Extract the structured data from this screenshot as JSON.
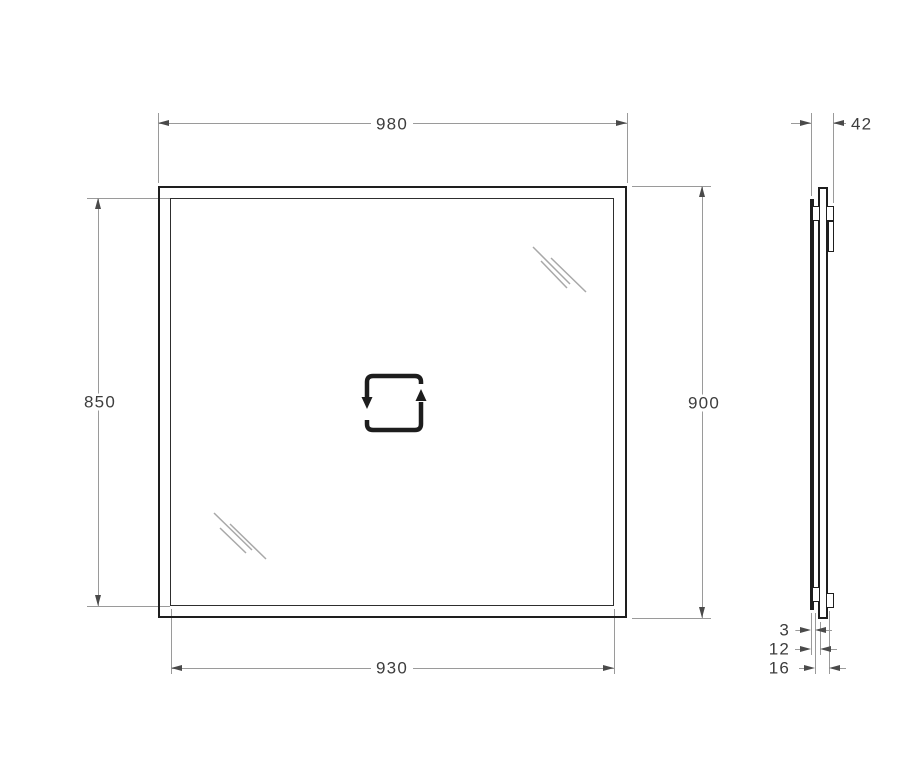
{
  "front_view": {
    "outer_width": "980",
    "inner_height": "850",
    "outer_height": "900",
    "inner_width": "930"
  },
  "side_view": {
    "total_depth": "42",
    "glass_thickness": "3",
    "frame_depth": "12",
    "bracket_depth": "16"
  }
}
